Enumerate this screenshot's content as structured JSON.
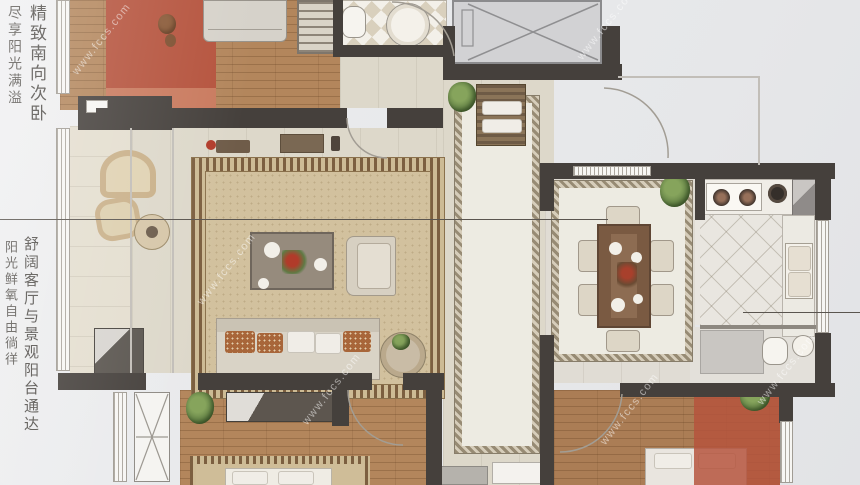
{
  "captions": {
    "top_primary": "精致南向次卧",
    "top_secondary": "尽享阳光满溢",
    "mid_primary": "舒阔客厅与景观阳台通达",
    "mid_secondary": "阳光鲜氧自由徜徉"
  },
  "watermark": {
    "text": "www.fccs.com"
  },
  "palette": {
    "highlight_red": "#b5533d",
    "wall": "#45403c",
    "wood": "#b3865c",
    "rug_beige": "#d2c19e",
    "paper": "#e9eaec"
  }
}
